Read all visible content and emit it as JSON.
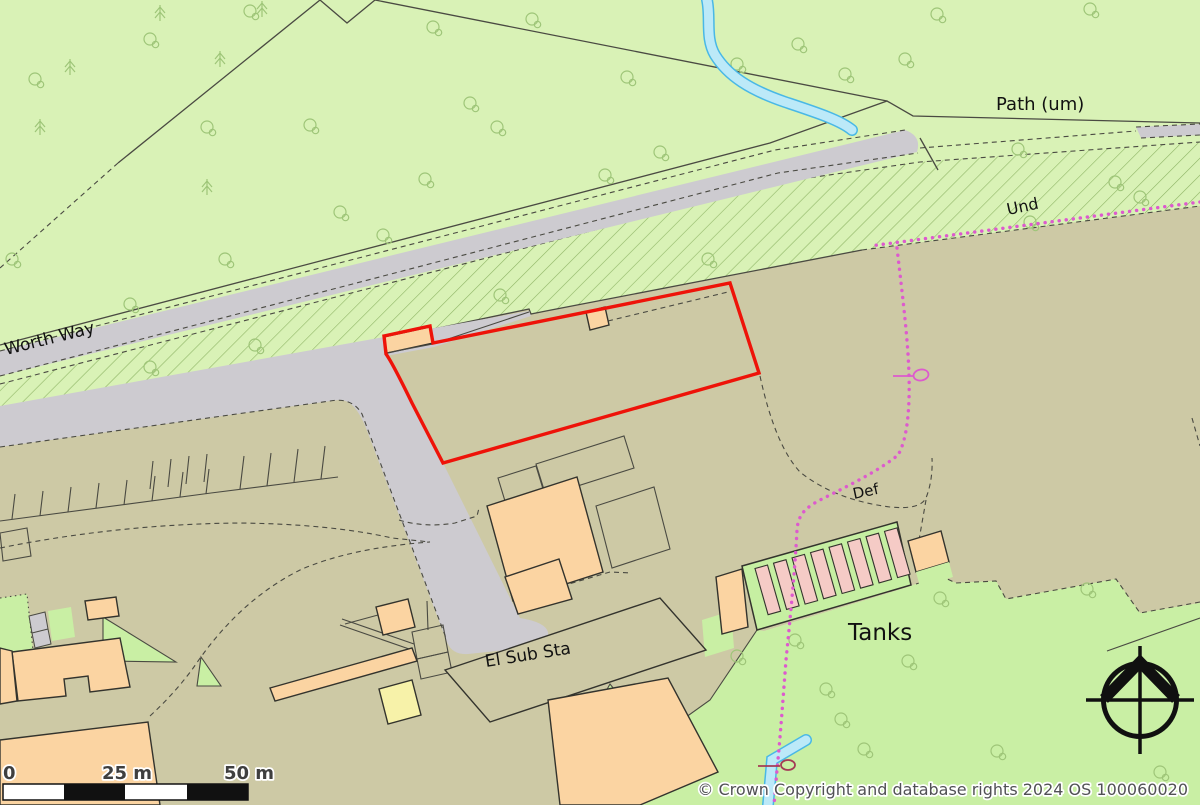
{
  "map": {
    "labels": {
      "road": "Worth Way",
      "path": "Path (um)",
      "boundary_und": "Und",
      "boundary_def": "Def",
      "substation": "El Sub Sta",
      "tanks": "Tanks"
    },
    "scale_bar": {
      "start": "0",
      "mid": "25 m",
      "end": "50 m"
    },
    "attribution": "© Crown Copyright and database rights 2024 OS 100060020",
    "icons": [
      "compass-rose-icon",
      "deciduous-tree-icon",
      "conifer-tree-icon",
      "boundary-post-icon"
    ],
    "colors": {
      "woodland": "#d9f2b6",
      "grass": "#c9efa4",
      "developed": "#cdc9a5",
      "road": "#cdcbd0",
      "building": "#fbd4a2",
      "building_yellow": "#f7f2a9",
      "tank": "#f5cbc6",
      "pen": "#c6efa2",
      "line": "#4a4a42",
      "outline": "#33332d",
      "red": "#ee1309",
      "magenta": "#dd5ace",
      "maroon": "#a43b55",
      "water": "#bce9f8",
      "water_edge": "#49b8e6",
      "tree": "#9ec578",
      "hatch": "#8fb566",
      "label": "#111111",
      "muted": "#515155",
      "scale_text": "#3f3f3f"
    }
  }
}
